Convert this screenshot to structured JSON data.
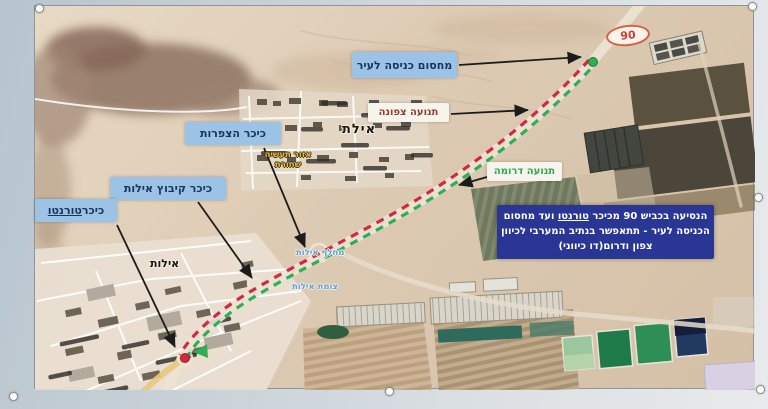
{
  "map": {
    "route_shield_label": "90",
    "callouts": {
      "barrier": "מחסום כניסה לעיר",
      "north_traffic": "תנועה צפונה",
      "south_traffic": "תנועה דרומה",
      "tsofrot": "כיכר הצפרות",
      "kibbutz_eilot": "כיכר קיבוץ אילות",
      "toronto_prefix": "כיכר ",
      "toronto_name": "טורנטו"
    },
    "info_box": {
      "line1_pre": "הנסיעה בכביש 90 מכיכר ",
      "line1_underline": "טורנטו",
      "line1_post": " ועד מחסום",
      "line2": "הכניסה לעיר - תתאפשר בנתיב המערבי לכיוון",
      "line3": "צפון ודרום(דו כיווני)"
    },
    "place_labels": {
      "city": "אילת",
      "kibbutz": "אילות",
      "industrial_line1": "אזור תעשיה",
      "industrial_line2": "שחורת",
      "interchange": "מחלף אילות",
      "junction": "צומת אילות"
    },
    "colors": {
      "callout_bg": "#9cc3e5",
      "callout_text": "#17365d",
      "north_text": "#8f3c2c",
      "south_text": "#2fa84e",
      "info_bg": "#2a3694",
      "route_red": "#d22840",
      "route_green": "#2fae54",
      "shield_red": "#c03a2a"
    }
  }
}
